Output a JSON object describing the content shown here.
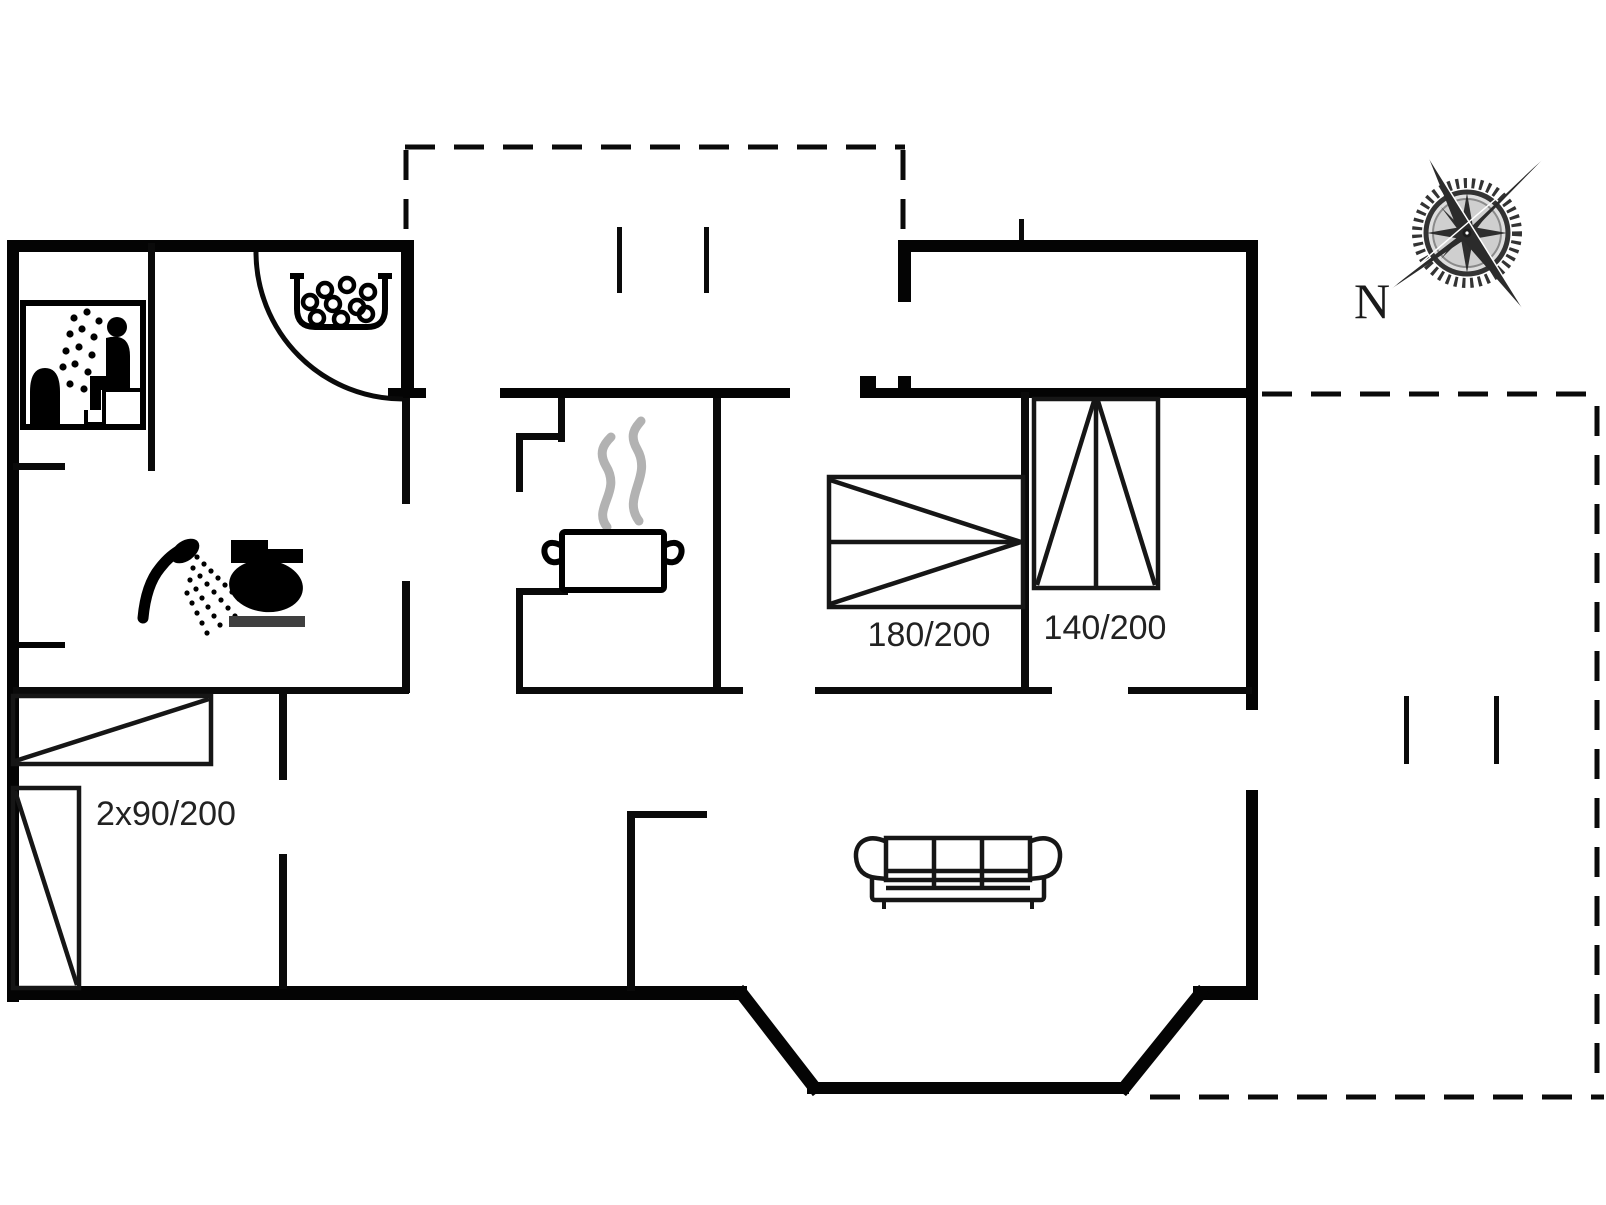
{
  "page": {
    "type": "holiday-home floor plan drawing",
    "background": "#ffffff"
  },
  "labels": {
    "bed_double": "180/200",
    "bed_140": "140/200",
    "bed_twin": "2x90/200"
  },
  "compass": {
    "north_label": "N"
  },
  "colors": {
    "wall": "#040404",
    "furniture_stroke": "#161616",
    "steam": "#b2b2b2",
    "label_text": "#222222",
    "toilet_base": "#3f3f3f",
    "compass_dark": "#2e2e2e"
  },
  "icons": [
    "sauna-icon",
    "whirlpool-icon",
    "shower-icon",
    "toilet-icon",
    "cooking-pot-icon",
    "sofa-icon",
    "compass-rose-icon"
  ]
}
